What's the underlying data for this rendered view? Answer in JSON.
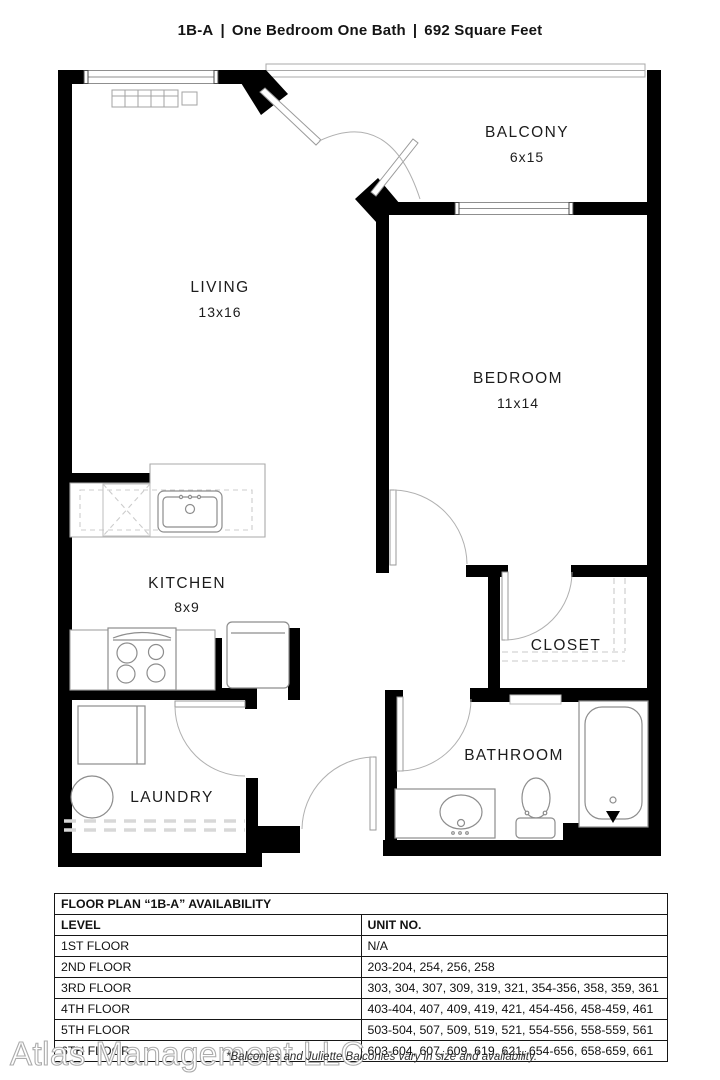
{
  "title": {
    "code": "1B-A",
    "separator": "|",
    "type": "One Bedroom One Bath",
    "sqft": "692 Square Feet"
  },
  "rooms": {
    "balcony": {
      "name": "BALCONY",
      "dims": "6x15"
    },
    "living": {
      "name": "LIVING",
      "dims": "13x16"
    },
    "bedroom": {
      "name": "BEDROOM",
      "dims": "11x14"
    },
    "kitchen": {
      "name": "KITCHEN",
      "dims": "8x9"
    },
    "closet": {
      "name": "CLOSET"
    },
    "bathroom": {
      "name": "BATHROOM"
    },
    "laundry": {
      "name": "LAUNDRY"
    }
  },
  "availability_table": {
    "title": "FLOOR PLAN “1B-A” AVAILABILITY",
    "columns": [
      "LEVEL",
      "UNIT NO."
    ],
    "rows": [
      [
        "1ST FLOOR",
        "N/A"
      ],
      [
        "2ND FLOOR",
        "203-204, 254, 256, 258"
      ],
      [
        "3RD FLOOR",
        "303, 304, 307, 309, 319, 321, 354-356, 358, 359, 361"
      ],
      [
        "4TH FLOOR",
        "403-404, 407, 409, 419, 421, 454-456, 458-459, 461"
      ],
      [
        "5TH FLOOR",
        "503-504, 507, 509, 519, 521, 554-556, 558-559, 561"
      ],
      [
        "6TH FLOOR",
        "603-604, 607, 609, 619, 621, 654-656, 658-659, 661"
      ]
    ]
  },
  "footer": {
    "watermark": "Atlas Management LLC",
    "note": "*Balconies and Juliette Balconies vary in size and availability."
  },
  "colors": {
    "wall": "#000000",
    "fixture_line": "#9b9b9b",
    "text": "#1c1c1c"
  }
}
